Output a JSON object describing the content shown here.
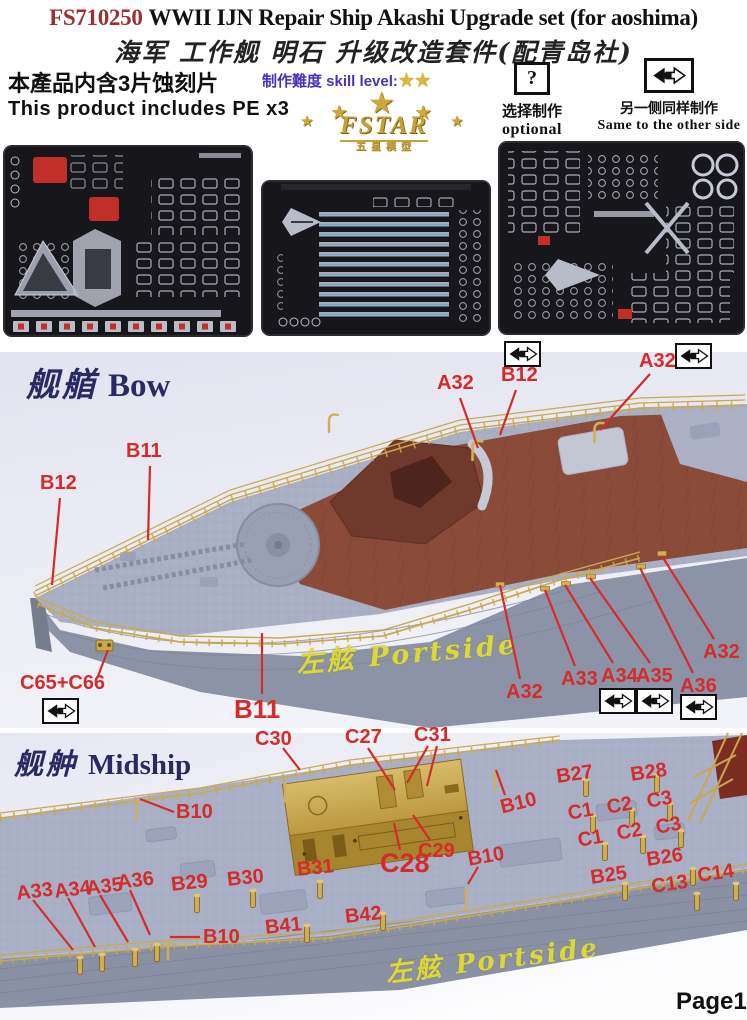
{
  "page": {
    "page_number": "Page1"
  },
  "colors": {
    "label_red": "#d42b2b",
    "title_code_red": "#9c2f2f",
    "section_navy": "#2a2a63",
    "brass_gold": "#c9a84f",
    "portside_yellow": "#ddd83a",
    "skill_blue": "#4433bb",
    "fret_background": "#17171b"
  },
  "header": {
    "title_code": "FS710250",
    "title_en": "WWII IJN Repair Ship Akashi Upgrade set (for aoshima)",
    "title_cn": "海军 工作舰 明石 升级改造套件(配青岛社)",
    "includes_cn": "本產品内含3片蚀刻片",
    "includes_en": "This product includes PE x3",
    "skill_label": "制作難度 skill level:",
    "skill_stars": 2,
    "logo_text": "FSTAR",
    "logo_sub": "五星模型",
    "optional_symbol": "?",
    "optional_cn": "选择制作",
    "optional_en": "optional",
    "mirror_cn": "另一侧同样制作",
    "mirror_en": "Same to the other side"
  },
  "sections": [
    {
      "id": "bow",
      "title_cn": "舰艏",
      "title_en": "Bow",
      "watermark": "左舷 Portside",
      "labels": [
        {
          "t": "A32",
          "x": 437,
          "y": 372,
          "line": [
            460,
            398,
            478,
            448
          ]
        },
        {
          "t": "B12",
          "x": 501,
          "y": 364,
          "line": [
            516,
            390,
            500,
            435
          ],
          "icon": [
            504,
            341
          ]
        },
        {
          "t": "A32",
          "x": 639,
          "y": 350,
          "line": [
            650,
            374,
            600,
            430
          ],
          "icon": [
            675,
            343
          ]
        },
        {
          "t": "B11",
          "x": 126,
          "y": 440,
          "line": [
            150,
            466,
            148,
            540
          ]
        },
        {
          "t": "B12",
          "x": 40,
          "y": 472,
          "line": [
            60,
            498,
            52,
            585
          ]
        },
        {
          "t": "C65+C66",
          "x": 20,
          "y": 672,
          "line": [
            98,
            676,
            108,
            650
          ],
          "icon": [
            42,
            698
          ]
        },
        {
          "t": "B11",
          "x": 234,
          "y": 694,
          "fs": 26,
          "line": [
            262,
            694,
            262,
            633
          ]
        },
        {
          "t": "A32",
          "x": 506,
          "y": 681,
          "line": [
            520,
            679,
            500,
            585
          ]
        },
        {
          "t": "A33",
          "x": 561,
          "y": 668,
          "line": [
            575,
            666,
            545,
            590
          ]
        },
        {
          "t": "A34",
          "x": 601,
          "y": 665,
          "line": [
            613,
            663,
            565,
            585
          ],
          "icon": [
            599,
            688
          ]
        },
        {
          "t": "A35",
          "x": 636,
          "y": 665,
          "line": [
            650,
            663,
            590,
            578
          ],
          "icon": [
            636,
            688
          ]
        },
        {
          "t": "A36",
          "x": 680,
          "y": 675,
          "line": [
            693,
            673,
            640,
            568
          ],
          "icon": [
            680,
            694
          ]
        },
        {
          "t": "A32",
          "x": 703,
          "y": 641,
          "line": [
            714,
            639,
            662,
            556
          ]
        }
      ]
    },
    {
      "id": "midship",
      "title_cn": "舰舯",
      "title_en": "Midship",
      "watermark": "左舷 Portside",
      "labels": [
        {
          "t": "C30",
          "x": 255,
          "y": 728,
          "line": [
            283,
            748,
            300,
            770
          ]
        },
        {
          "t": "C27",
          "x": 345,
          "y": 726,
          "line": [
            368,
            748,
            395,
            790
          ]
        },
        {
          "t": "C31",
          "x": 414,
          "y": 724,
          "line": [
            428,
            746,
            407,
            783
          ],
          "line2": [
            437,
            746,
            427,
            786
          ]
        },
        {
          "t": "B10",
          "x": 176,
          "y": 801,
          "line": [
            174,
            812,
            140,
            799
          ]
        },
        {
          "t": "B10",
          "x": 498,
          "y": 797,
          "r": -14,
          "line": [
            505,
            795,
            496,
            770
          ]
        },
        {
          "t": "C29",
          "x": 418,
          "y": 840,
          "line": [
            430,
            840,
            413,
            815
          ]
        },
        {
          "t": "C28",
          "x": 380,
          "y": 848,
          "fs": 27,
          "line": [
            400,
            850,
            394,
            823
          ]
        },
        {
          "t": "B10",
          "x": 466,
          "y": 849,
          "r": -10,
          "line": [
            478,
            867,
            468,
            884
          ]
        },
        {
          "t": "B27",
          "x": 555,
          "y": 766,
          "r": -8
        },
        {
          "t": "B28",
          "x": 629,
          "y": 764,
          "r": -8
        },
        {
          "t": "C1",
          "x": 566,
          "y": 803,
          "r": -10
        },
        {
          "t": "C2",
          "x": 605,
          "y": 797,
          "r": -10
        },
        {
          "t": "C3",
          "x": 645,
          "y": 791,
          "r": -10
        },
        {
          "t": "C1",
          "x": 576,
          "y": 830,
          "r": -10
        },
        {
          "t": "C2",
          "x": 615,
          "y": 823,
          "r": -10
        },
        {
          "t": "C3",
          "x": 654,
          "y": 817,
          "r": -10
        },
        {
          "t": "B26",
          "x": 645,
          "y": 849,
          "r": -8
        },
        {
          "t": "B25",
          "x": 589,
          "y": 867,
          "r": -8
        },
        {
          "t": "C13",
          "x": 650,
          "y": 876,
          "r": -8
        },
        {
          "t": "C14",
          "x": 696,
          "y": 865,
          "r": -8
        },
        {
          "t": "A33",
          "x": 15,
          "y": 883,
          "r": -7,
          "line": [
            33,
            900,
            73,
            950
          ]
        },
        {
          "t": "A34",
          "x": 53,
          "y": 881,
          "r": -7,
          "line": [
            68,
            898,
            95,
            947
          ]
        },
        {
          "t": "A35",
          "x": 85,
          "y": 878,
          "r": -7,
          "line": [
            100,
            895,
            128,
            942
          ]
        },
        {
          "t": "A36",
          "x": 116,
          "y": 872,
          "r": -7,
          "line": [
            130,
            890,
            150,
            935
          ]
        },
        {
          "t": "B29",
          "x": 170,
          "y": 874,
          "r": -6
        },
        {
          "t": "B30",
          "x": 226,
          "y": 869,
          "r": -6
        },
        {
          "t": "B31",
          "x": 296,
          "y": 859,
          "r": -6
        },
        {
          "t": "B41",
          "x": 264,
          "y": 917,
          "r": -6
        },
        {
          "t": "B42",
          "x": 344,
          "y": 906,
          "r": -6
        },
        {
          "t": "B10",
          "x": 203,
          "y": 926,
          "line": [
            200,
            937,
            170,
            937
          ]
        }
      ]
    }
  ]
}
